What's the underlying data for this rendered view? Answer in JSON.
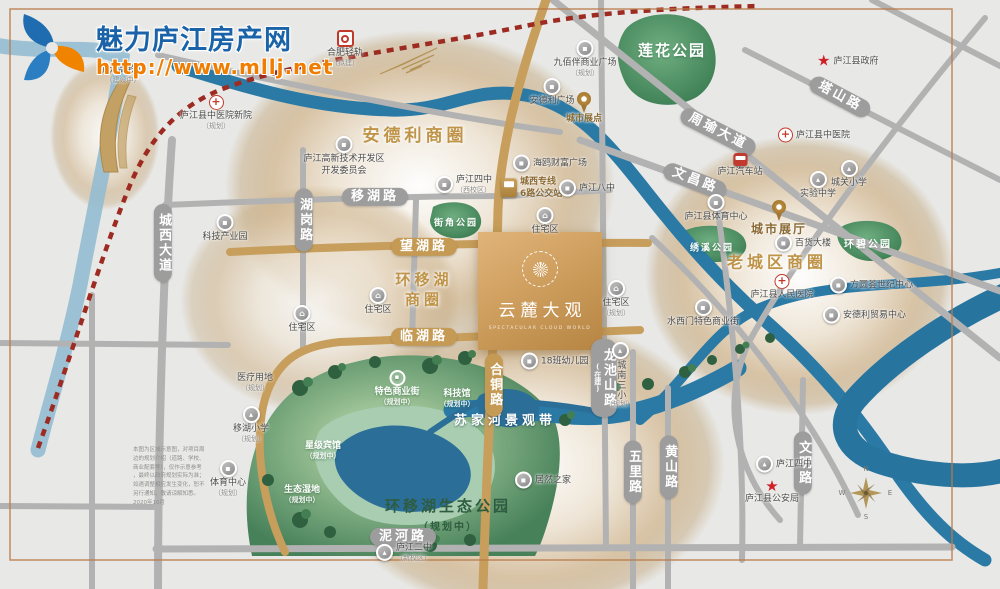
{
  "logo": {
    "title": "魅力庐江房产网",
    "url": "http://www.mllj.net"
  },
  "property": {
    "name": "云麓大观",
    "subtitle": "SPECTACULAR CLOUD WORLD"
  },
  "zones": [
    {
      "lines": [
        "安德利商圈"
      ],
      "x": 415,
      "y": 136,
      "size": 17
    },
    {
      "lines": [
        "环移湖",
        "商圈"
      ],
      "x": 424,
      "y": 290,
      "size": 15
    },
    {
      "lines": [
        "老城区商圈"
      ],
      "x": 777,
      "y": 263,
      "size": 16
    }
  ],
  "roads": [
    {
      "l": "城西大道",
      "x": 163,
      "y": 243,
      "vert": 1
    },
    {
      "l": "湖岗路",
      "x": 304,
      "y": 220,
      "vert": 1
    },
    {
      "l": "移湖路",
      "x": 375,
      "y": 197
    },
    {
      "l": "望湖路",
      "x": 424,
      "y": 247,
      "gold": 1
    },
    {
      "l": "临湖路",
      "x": 424,
      "y": 337,
      "gold": 1
    },
    {
      "l": "合铜路",
      "x": 494,
      "y": 385,
      "vert": 1,
      "gold": 1
    },
    {
      "l": "龙池山路",
      "sub": "(在建)",
      "x": 604,
      "y": 378,
      "vert": 1
    },
    {
      "l": "五里路",
      "x": 633,
      "y": 472,
      "vert": 1
    },
    {
      "l": "黄山路",
      "x": 669,
      "y": 467,
      "vert": 1
    },
    {
      "l": "文明路",
      "x": 803,
      "y": 463,
      "vert": 1
    },
    {
      "l": "泥河路",
      "x": 403,
      "y": 537
    },
    {
      "l": "文昌路",
      "x": 695,
      "y": 181,
      "ang": 21
    },
    {
      "l": "周瑜大道",
      "x": 718,
      "y": 132,
      "ang": 27
    },
    {
      "l": "塔山路",
      "x": 840,
      "y": 97,
      "ang": 28
    }
  ],
  "parks": [
    {
      "l": "莲花公园",
      "x": 672,
      "y": 50,
      "size": 15
    },
    {
      "l": "街角公园",
      "x": 456,
      "y": 222,
      "size": 9
    },
    {
      "l": "绣溪公园",
      "x": 712,
      "y": 247,
      "size": 9
    },
    {
      "l": "环碧公园",
      "x": 868,
      "y": 243,
      "size": 10
    }
  ],
  "water": {
    "label": "苏家河景观带"
  },
  "eco_park": {
    "name": "环移湖生态公园",
    "status": "（规划中）"
  },
  "pois": [
    {
      "n": "庐江高铁站",
      "s": "（建设中）",
      "t": "none",
      "x": 123,
      "y": 64
    },
    {
      "n": "合肥轻轨",
      "s": "（拟建）",
      "t": "metro",
      "x": 345,
      "y": 30
    },
    {
      "n": "庐江县中医院新院",
      "s": "（规划）",
      "t": "cross",
      "x": 216,
      "y": 95
    },
    {
      "n": "庐江高新技术开发区",
      "n2": "开发委员会",
      "t": "dot",
      "x": 344,
      "y": 136
    },
    {
      "n": "科技产业园",
      "t": "dot",
      "x": 225,
      "y": 214
    },
    {
      "n": "九佰伴商业广场",
      "s": "（规划）",
      "t": "dot",
      "x": 585,
      "y": 40
    },
    {
      "n": "安德利广场",
      "t": "dot",
      "x": 552,
      "y": 78
    },
    {
      "n": "城市展点",
      "t": "pin",
      "x": 584,
      "y": 92,
      "cls": "goldlabel"
    },
    {
      "n": "海鸥财富广场",
      "t": "dot",
      "x": 520,
      "y": 163,
      "side": "right"
    },
    {
      "n": "庐江四中",
      "s": "（西校区）",
      "t": "dot",
      "x": 443,
      "y": 184,
      "side": "right"
    },
    {
      "n": "城西专线",
      "n2": "6路公交站",
      "t": "busgold",
      "x": 508,
      "y": 188,
      "side": "right",
      "cls": "goldlabel"
    },
    {
      "n": "庐江八中",
      "t": "dot",
      "x": 566,
      "y": 188,
      "side": "right"
    },
    {
      "n": "住宅区",
      "t": "house",
      "x": 378,
      "y": 287
    },
    {
      "n": "住宅区",
      "t": "house",
      "x": 302,
      "y": 305
    },
    {
      "n": "住宅区",
      "t": "house",
      "x": 545,
      "y": 207
    },
    {
      "n": "住宅区",
      "s": "（规划）",
      "t": "house",
      "x": 616,
      "y": 280
    },
    {
      "n": "18班幼儿园",
      "t": "dot",
      "x": 528,
      "y": 361,
      "side": "right"
    },
    {
      "n": "城南三小",
      "s": "（规划）",
      "t": "school",
      "x": 620,
      "y": 342,
      "vert": 1
    },
    {
      "n": "居然之家",
      "t": "dot",
      "x": 522,
      "y": 480,
      "side": "right"
    },
    {
      "n": "庐江县政府",
      "t": "star",
      "x": 824,
      "y": 61,
      "side": "right"
    },
    {
      "n": "庐江县中医院",
      "t": "cross",
      "x": 785,
      "y": 135,
      "side": "right"
    },
    {
      "n": "庐江汽车站",
      "t": "busred",
      "x": 740,
      "y": 153
    },
    {
      "n": "城关小学",
      "t": "school",
      "x": 849,
      "y": 160
    },
    {
      "n": "实验中学",
      "t": "school",
      "x": 818,
      "y": 171
    },
    {
      "n": "庐江县体育中心",
      "t": "dot",
      "x": 716,
      "y": 194
    },
    {
      "n": "城市展厅",
      "t": "pin",
      "x": 779,
      "y": 200,
      "cls": "goldlabel big"
    },
    {
      "n": "百货大楼",
      "t": "dot",
      "x": 782,
      "y": 243,
      "side": "right"
    },
    {
      "n": "方圆荟世纪中心",
      "t": "dot",
      "x": 837,
      "y": 285,
      "side": "right"
    },
    {
      "n": "安德利贸易中心",
      "t": "dot",
      "x": 830,
      "y": 315,
      "side": "right"
    },
    {
      "n": "庐江县人民医院",
      "t": "cross",
      "x": 782,
      "y": 274
    },
    {
      "n": "水西门特色商业街",
      "t": "dot",
      "x": 703,
      "y": 299
    },
    {
      "n": "移湖小学",
      "s": "（规划）",
      "t": "school",
      "x": 251,
      "y": 406
    },
    {
      "n": "体育中心",
      "s": "（规划）",
      "t": "dot",
      "x": 228,
      "y": 460
    },
    {
      "n": "医疗用地",
      "s": "（规划）",
      "t": "none",
      "x": 255,
      "y": 372
    },
    {
      "n": "庐江二中",
      "s": "（新校区）",
      "t": "school",
      "x": 383,
      "y": 552,
      "side": "right"
    },
    {
      "n": "庐江四中",
      "t": "school",
      "x": 763,
      "y": 464,
      "side": "right"
    },
    {
      "n": "庐江县公安局",
      "t": "star",
      "x": 772,
      "y": 480
    },
    {
      "n": "特色商业街",
      "s": "（规划中）",
      "t": "dotwhite",
      "x": 397,
      "y": 370,
      "cls": "white"
    },
    {
      "n": "星级宾馆",
      "s": "（规划中）",
      "t": "none",
      "x": 323,
      "y": 440,
      "cls": "white"
    },
    {
      "n": "生态湿地",
      "s": "（规划中）",
      "t": "none",
      "x": 302,
      "y": 484,
      "cls": "white"
    },
    {
      "n": "科技馆",
      "s": "（规划中）",
      "t": "none",
      "x": 457,
      "y": 388,
      "cls": "white"
    }
  ],
  "compass": {
    "n": "N",
    "e": "E",
    "s": "S",
    "w": "W"
  },
  "disclaimer": {
    "lines": [
      "本图为区域示意图，对项目周",
      "边的规划介绍（道路、学校、",
      "商业配套等），仅作示意参考",
      "，最终以政府规划实际为准；",
      "如遇调整相应发生变化，恕不",
      "另行通知，敬请谅解知悉。",
      "2020年10月"
    ]
  },
  "colors": {
    "gold_road": "#c79e5c",
    "gray_road": "#b2b2b2",
    "river": "#2a7aa5",
    "park_green": "#4a8f63",
    "zone_gold": "#bf9448",
    "railway_red": "#9d2b22",
    "brand_blue": "#1a63a8",
    "brand_orange": "#f07c00",
    "property_gold": "#cf9f5f"
  }
}
